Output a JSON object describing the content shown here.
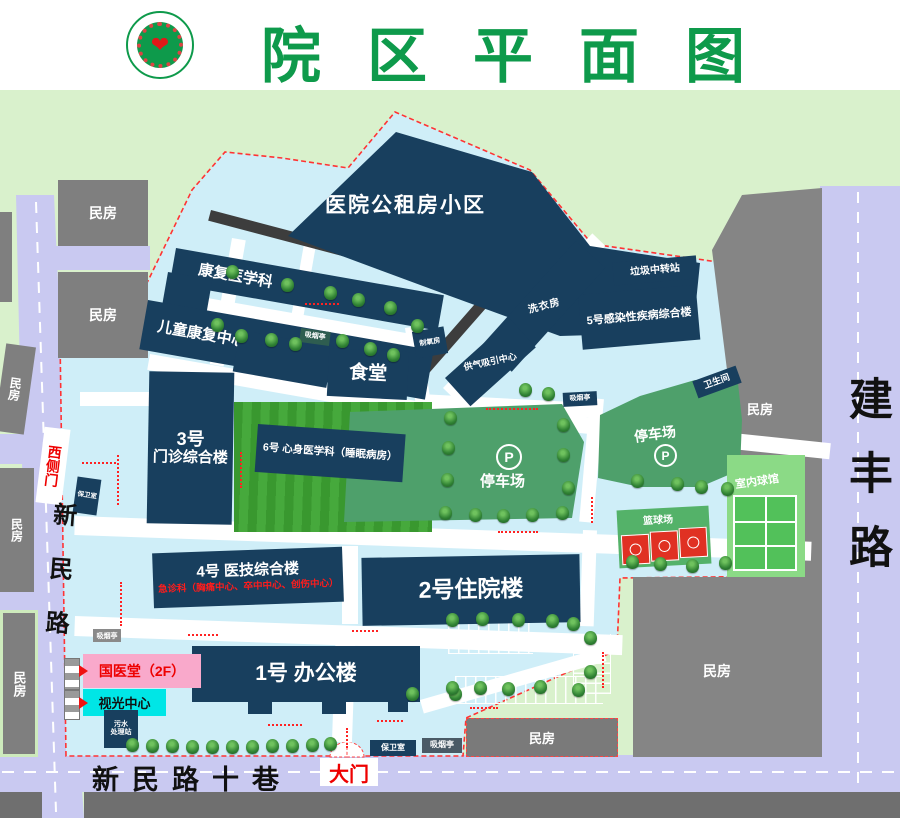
{
  "header": {
    "title": "院区平面图",
    "logo": {
      "name": "hospital-logo",
      "heart": "❤"
    }
  },
  "map": {
    "buildings": {
      "public_housing": "医院公租房小区",
      "rehab": "康复医学科",
      "child_rehab": "儿童康复中心",
      "canteen": "食堂",
      "no3_line1": "3号",
      "no3_line2": "门诊综合楼",
      "no6": "6号 心身医学科（睡眠病房）",
      "no5": "5号感染性疾病综合楼",
      "no4": "4号 医技综合楼",
      "no4_emergency": "急诊科（胸痛中心、卒中中心、创伤中心）",
      "no2": "2号住院楼",
      "no1": "1号 办公楼",
      "tcm_hall": "国医堂（2F）",
      "optometry": "视光中心",
      "sewage_line1": "污水",
      "sewage_line2": "处理站",
      "garbage": "垃圾中转站",
      "laundry": "洗衣房",
      "gas_suction": "供气吸引中心",
      "oxygen": "制氧房",
      "guard": "保卫室",
      "smoking": "吸烟亭",
      "toilet": "卫生间",
      "residential": "民房"
    },
    "areas": {
      "parking": "停车场",
      "parking_symbol": "P",
      "basketball": "篮球场",
      "indoor_gym": "室内球馆"
    },
    "roads": {
      "xinmin": "新民路",
      "jianfeng": "建丰路",
      "lane": "新民路十巷",
      "west_gate": "西侧门",
      "main_gate": "大门"
    }
  },
  "colors": {
    "title_green": "#0e9a4b",
    "building_navy": "#183f5e",
    "campus_blue": "#cfeef8",
    "background_green": "#d9f1cc",
    "road_lavender": "#c9c9f1",
    "parking_green": "#4ea06b",
    "lawn_green": "#3a9a33",
    "accent_red": "#ff2222",
    "tcm_pink": "#f9a9cb",
    "optometry_cyan": "#00e6e6"
  }
}
